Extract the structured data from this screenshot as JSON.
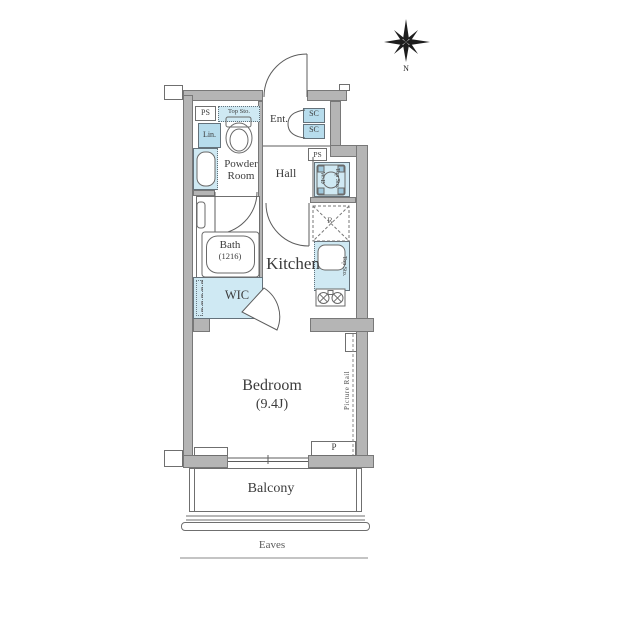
{
  "compass": {
    "north_label": "N"
  },
  "labels": {
    "ps_top": "PS",
    "top_sto_toilet": "Top Sto.",
    "lin": "Lin.",
    "powder_room": "Powder Room",
    "ent": "Ent.",
    "sc_upper": "SC",
    "sc_lower": "SC",
    "ps_right": "PS",
    "hall": "Hall",
    "wd": "W/D",
    "top_sto_laundry": "Top Sto.",
    "fridge": "R",
    "top_sto_kitchen": "Top Sto.",
    "bath_name": "Bath",
    "bath_size": "(1216)",
    "kitchen": "Kitchen",
    "wic": "WIC",
    "bedroom_name": "Bedroom",
    "bedroom_size": "(9.4J)",
    "picture_rail": "Picture Rail",
    "p": "P",
    "balcony": "Balcony",
    "eaves": "Eaves"
  },
  "colors": {
    "wall_fill": "#b5b5b5",
    "wall_outline": "#787878",
    "fixture_blue_light": "#cfe9f3",
    "fixture_blue_dark": "#b7dcec",
    "linework": "#5c5c5c",
    "text": "#3b3b3b"
  }
}
